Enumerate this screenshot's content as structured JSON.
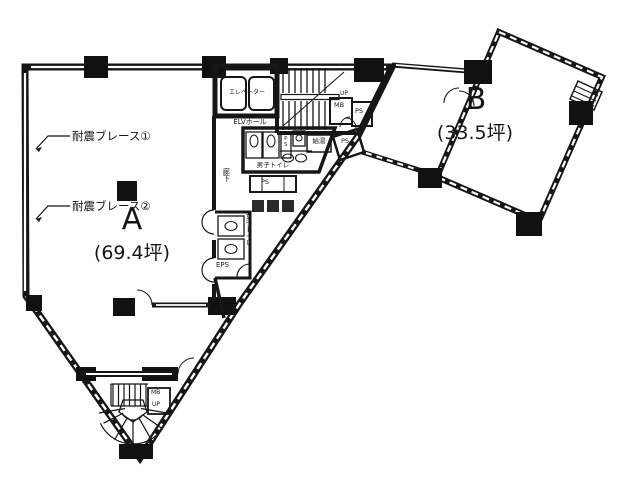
{
  "plan": {
    "units": {
      "a_name": "A",
      "a_area": "(69.4坪)",
      "b_name": "B",
      "b_area": "(33.5坪)"
    },
    "annotations": {
      "brace1": "耐震ブレース①",
      "brace2": "耐震ブレース②"
    },
    "core": {
      "elevator": "エレベーター",
      "elevator_hall": "ELVホール",
      "mens_toilet": "男子トイレ",
      "womens_toilet": "女子トイレ",
      "corridor": "廊下",
      "kitchenette": "給湯",
      "eps": "EPS",
      "ps_fixture": "PS",
      "ps_toilet": "PS",
      "ps_stair": "PS",
      "ps_b": "PS",
      "mb_stair": "MB",
      "mb_entry": "MB",
      "up_main": "UP",
      "up_entry": "UP"
    },
    "colors": {
      "line": "#161616",
      "bg": "#ffffff"
    }
  }
}
